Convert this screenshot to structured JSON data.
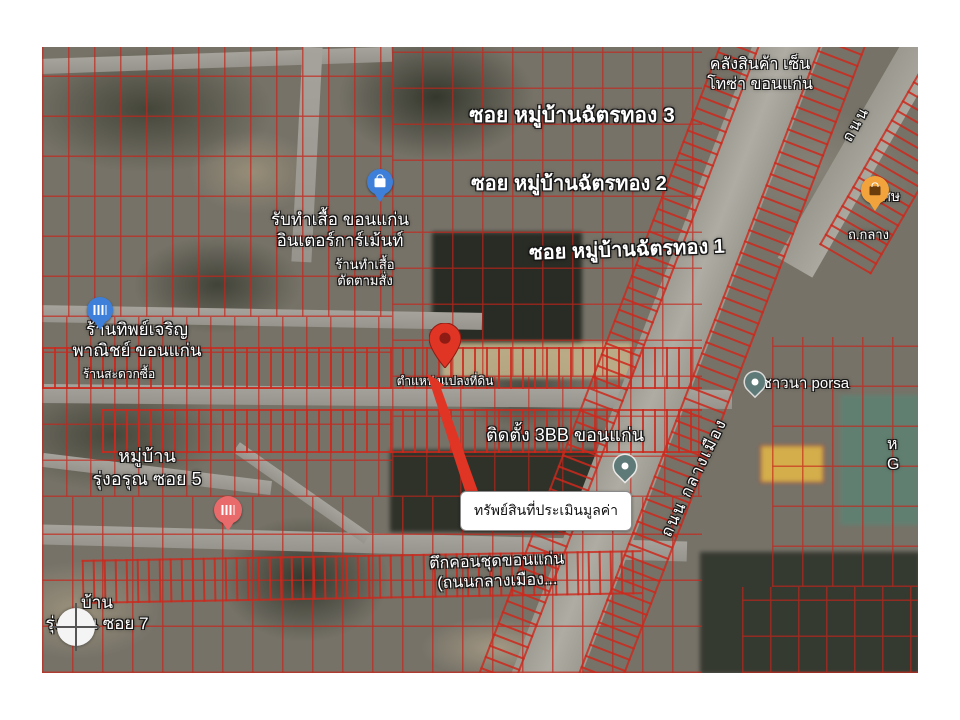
{
  "map": {
    "type": "satellite-cadastral-overlay",
    "labels": {
      "warehouse": "คลังสินค้า เซ็น\nโทซ่า ขอนแก่น",
      "soi3": "ซอย หมู่บ้านฉัตรทอง 3",
      "soi2": "ซอย หมู่บ้านฉัตรทอง 2",
      "soi1": "ซอย หมู่บ้านฉัตรทอง 1",
      "shirt_shop": "รับทำเสื้อ ขอนแก่น\nอินเตอร์การ์เม้นท์",
      "shirt_shop_small": "ร้านทำเสื้อ\nตัดตามสั่ง",
      "tip_charoen": "ร้านทิพย์เจริญ\nพาณิชย์ ขอนแก่น",
      "convenience": "ร้านสะดวกซื้อ",
      "village_soi5": "หมู่บ้าน\nรุ่งอรุณ ซอย 5",
      "village_soi7": "บ้าน\nรุ่งอรุณ ซอย 7",
      "parcel_position": "ตำแหน่งแปลงที่ดิน",
      "bb3": "ติดตั้ง 3BB ขอนแก่น",
      "condo": "ตึกคอนชุดขอนแก่น\n(ถนนกลางเมือง...",
      "porsa": "บ.ชาวนา porsa",
      "road_klang_mueang": "ถนน กลางเมือง",
      "road_thanon": "ถนน",
      "road_short": "ถ.กลาง",
      "sorn_partial": "ศษ",
      "edge_partial": "ห\nG"
    },
    "callout": {
      "text": "ทรัพย์สินที่ประเมินมูลค่า"
    },
    "markers": {
      "property_pin": "red-map-pin",
      "shopping_top": "blue-shopping-marker",
      "shopping_left": "blue-shopping-marker",
      "shopping_pink": "pink-shopping-marker",
      "poi_orange": "orange-poi-marker",
      "poi_teal_center": "teal-teardrop-marker",
      "poi_teal_right": "teal-teardrop-marker",
      "crosshair": "crosshair-target-icon"
    },
    "colors": {
      "parcel_line": "#c8281e",
      "pin_red": "#e03525",
      "road_gray": "#9c9a92",
      "marker_blue": "#3d7fd9",
      "marker_orange": "#f2a33c",
      "marker_pink": "#e86a6a",
      "marker_teal": "#5e7a78"
    }
  }
}
